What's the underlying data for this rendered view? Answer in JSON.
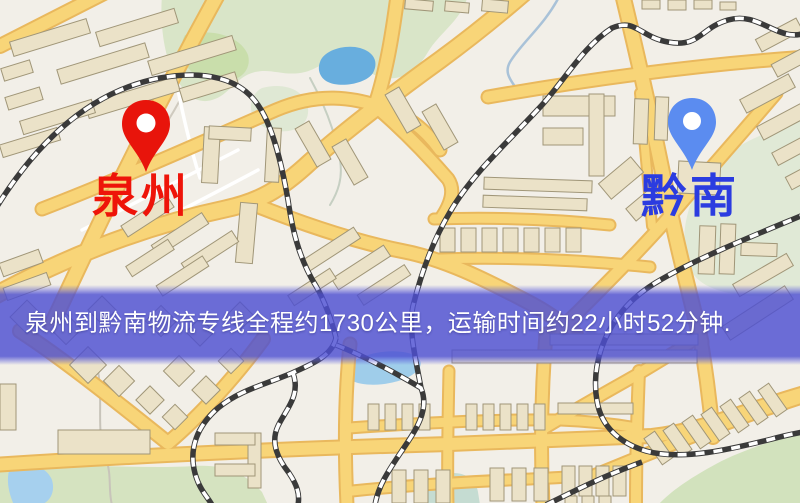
{
  "map": {
    "origin_marker": {
      "label": "泉州",
      "pin_style": "red-location-pin",
      "pin_color": "#e8140b",
      "label_color": "#ee1409"
    },
    "destination_marker": {
      "label": "黔南",
      "pin_style": "blue-location-pin",
      "pin_color": "#5b8cf0",
      "label_color": "#2b3ce0"
    },
    "route_banner": {
      "text": "泉州到黔南物流专线全程约1730公里，运输时间约22小时52分钟.",
      "origin": "泉州",
      "destination": "黔南",
      "distance": "约1730公里",
      "duration": "约22小时52分钟",
      "background_color": "#4d4fd2",
      "text_color": "#ffffff"
    },
    "legend_colors": {
      "road": "#f8d578",
      "building": "#ebe2c8",
      "green_area": "#d9e5c8",
      "water": "#68aede",
      "railway": "#3a3a3a",
      "map_background": "#f2efe8"
    }
  }
}
